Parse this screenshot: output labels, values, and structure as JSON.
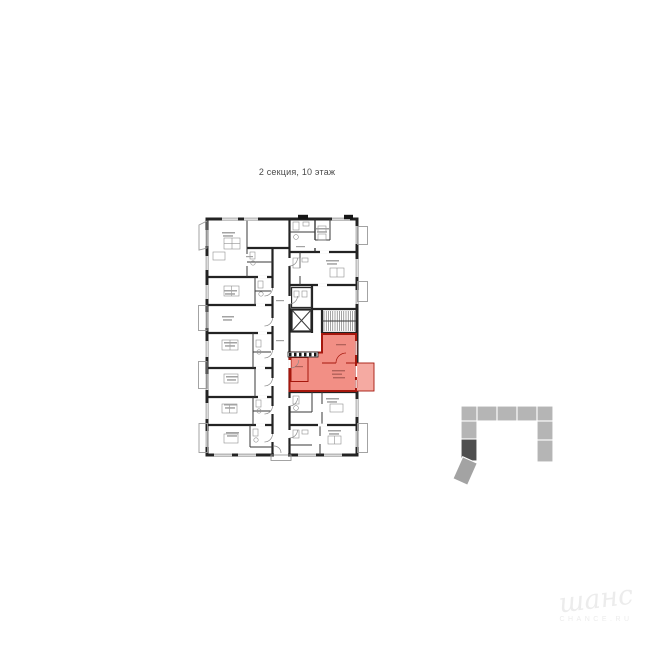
{
  "title": {
    "text": "2 секция, 10 этаж"
  },
  "floor_plan": {
    "description": "apartment building floor plan with one highlighted unit",
    "highlighted_unit": "selected-apartment"
  },
  "locator": {
    "description": "building footprint mini-map with active section",
    "active_section": "2"
  },
  "watermark": {
    "script": "шанс",
    "caption": "CHANCE.RU"
  },
  "colors": {
    "background": "#ffffff",
    "wall": "#232323",
    "window_line": "#777777",
    "title_text": "#4a4a4a",
    "smudge": "#a3a3a3",
    "highlight_fill": "#f1857b",
    "highlight_stroke": "#a6170d",
    "highlight_balcony": "#f5aaa2",
    "locator_block": "#b5b5b5",
    "locator_block_tilted": "#a3a3a3",
    "locator_active": "#4f4f4f",
    "watermark": "#ececec"
  }
}
